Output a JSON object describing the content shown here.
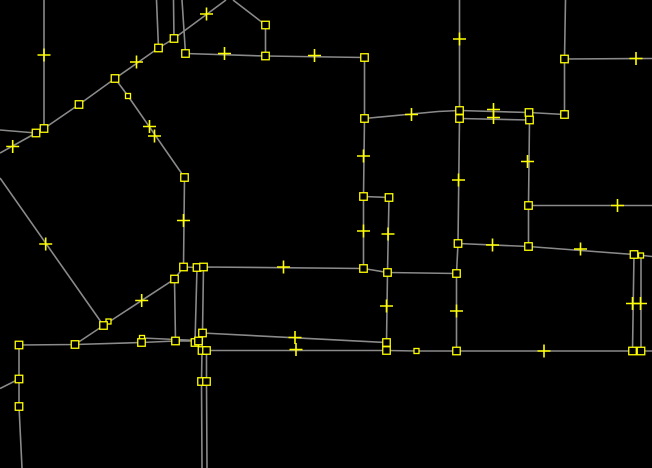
{
  "canvas": {
    "width": 652,
    "height": 468,
    "background_color": "#000000",
    "way_color": "#8a8a8a",
    "way_stroke_width": 1.6,
    "node_color": "#ffff00",
    "node_size": 7.5,
    "small_node_size": 5,
    "node_stroke_width": 1.3,
    "virtual_node_arm": 6.5,
    "virtual_node_stroke_width": 1.6
  },
  "geometry": {
    "ways": [
      {
        "points": [
          [
            0,
            153
          ],
          [
            36,
            133
          ],
          [
            44,
            128.5
          ],
          [
            79,
            104.5
          ],
          [
            115,
            78.5
          ],
          [
            158.5,
            48
          ],
          [
            174,
            38.5
          ],
          [
            226,
            0
          ]
        ]
      },
      {
        "points": [
          [
            115,
            78.5
          ],
          [
            128,
            96
          ],
          [
            184.5,
            177.5
          ],
          [
            183.5,
            267
          ]
        ]
      },
      {
        "points": [
          [
            44,
            0
          ],
          [
            44,
            128.5
          ]
        ]
      },
      {
        "points": [
          [
            0,
            130
          ],
          [
            36,
            133
          ]
        ]
      },
      {
        "points": [
          [
            0,
            178
          ],
          [
            103.5,
            325.5
          ]
        ]
      },
      {
        "points": [
          [
            103.5,
            325.5
          ],
          [
            174.5,
            279
          ],
          [
            183.5,
            267
          ]
        ]
      },
      {
        "points": [
          [
            103.5,
            325.5
          ],
          [
            75,
            344.5
          ],
          [
            19,
            345
          ],
          [
            19,
            379
          ],
          [
            19,
            406.5
          ],
          [
            22,
            468
          ]
        ]
      },
      {
        "points": [
          [
            0,
            388.5
          ],
          [
            19,
            379
          ]
        ]
      },
      {
        "points": [
          [
            75,
            344.5
          ],
          [
            141.5,
            342.5
          ],
          [
            175.5,
            341
          ],
          [
            198.5,
            341
          ]
        ]
      },
      {
        "points": [
          [
            142,
            338
          ],
          [
            198.5,
            340.5
          ]
        ]
      },
      {
        "points": [
          [
            197,
            267.5
          ],
          [
            195,
            342.5
          ]
        ]
      },
      {
        "points": [
          [
            203.5,
            267
          ],
          [
            202.5,
            333
          ],
          [
            202,
            350.5
          ],
          [
            201.5,
            381.5
          ],
          [
            202,
            468
          ]
        ]
      },
      {
        "points": [
          [
            206.5,
            350.5
          ],
          [
            206.5,
            381.5
          ],
          [
            207,
            468
          ]
        ]
      },
      {
        "points": [
          [
            174.5,
            279
          ],
          [
            175.5,
            341
          ]
        ]
      },
      {
        "points": [
          [
            202.5,
            333
          ],
          [
            386.5,
            342.5
          ]
        ]
      },
      {
        "points": [
          [
            202,
            350.5
          ],
          [
            386.5,
            350.5
          ],
          [
            416.5,
            351
          ],
          [
            456.5,
            351
          ],
          [
            632.5,
            351
          ],
          [
            641,
            351
          ],
          [
            652,
            351
          ]
        ]
      },
      {
        "points": [
          [
            183.5,
            267
          ],
          [
            197,
            267.5
          ],
          [
            203.5,
            267
          ],
          [
            363.5,
            268.5
          ],
          [
            387.5,
            272.5
          ],
          [
            456.5,
            273.5
          ]
        ]
      },
      {
        "points": [
          [
            389,
            197.5
          ],
          [
            387.5,
            272.5
          ],
          [
            386.5,
            342.5
          ],
          [
            386.5,
            350.5
          ]
        ]
      },
      {
        "points": [
          [
            182,
            0
          ],
          [
            185.5,
            53.5
          ],
          [
            265.5,
            56
          ],
          [
            364.5,
            57.5
          ]
        ]
      },
      {
        "points": [
          [
            233,
            0
          ],
          [
            265.5,
            25
          ],
          [
            265.5,
            56
          ]
        ]
      },
      {
        "points": [
          [
            156.5,
            0
          ],
          [
            158.5,
            48
          ]
        ]
      },
      {
        "points": [
          [
            173.5,
            0
          ],
          [
            174,
            38.5
          ]
        ]
      },
      {
        "points": [
          [
            364.5,
            57.5
          ],
          [
            364.5,
            118.5
          ],
          [
            363.5,
            196.5
          ],
          [
            363.5,
            268.5
          ]
        ]
      },
      {
        "points": [
          [
            363.5,
            196.5
          ],
          [
            389,
            197.5
          ]
        ]
      },
      {
        "points": [
          [
            364.5,
            118.5
          ],
          [
            438,
            111.5
          ],
          [
            459.5,
            110.5
          ],
          [
            529,
            112.5
          ],
          [
            564.5,
            114.5
          ]
        ]
      },
      {
        "points": [
          [
            459.5,
            118.5
          ],
          [
            529.5,
            120
          ]
        ]
      },
      {
        "points": [
          [
            459.5,
            0
          ],
          [
            459.5,
            110.5
          ],
          [
            459.5,
            118.5
          ],
          [
            458,
            243.5
          ],
          [
            456.5,
            273.5
          ],
          [
            456.5,
            351
          ]
        ]
      },
      {
        "points": [
          [
            565.5,
            0
          ],
          [
            564.5,
            59
          ],
          [
            564.5,
            114.5
          ]
        ]
      },
      {
        "points": [
          [
            564.5,
            59
          ],
          [
            652,
            58.5
          ]
        ]
      },
      {
        "points": [
          [
            529.5,
            120
          ],
          [
            528.5,
            205.5
          ],
          [
            528.5,
            246.5
          ]
        ]
      },
      {
        "points": [
          [
            528.5,
            205.5
          ],
          [
            652,
            205.5
          ]
        ]
      },
      {
        "points": [
          [
            458,
            243.5
          ],
          [
            528.5,
            246.5
          ],
          [
            634,
            254.5
          ],
          [
            652,
            256.5
          ]
        ]
      },
      {
        "points": [
          [
            634,
            254.5
          ],
          [
            632.5,
            351
          ]
        ]
      },
      {
        "points": [
          [
            641,
            255.5
          ],
          [
            641,
            351
          ]
        ]
      }
    ],
    "nodes": [
      [
        36,
        133
      ],
      [
        44,
        128.5
      ],
      [
        79,
        104.5
      ],
      [
        115,
        78.5
      ],
      [
        158.5,
        48
      ],
      [
        174,
        38.5
      ],
      [
        185.5,
        53.5
      ],
      [
        265.5,
        25
      ],
      [
        265.5,
        56
      ],
      [
        364.5,
        57.5
      ],
      [
        184.5,
        177.5
      ],
      [
        183.5,
        267
      ],
      [
        197,
        267.5
      ],
      [
        203.5,
        267
      ],
      [
        174.5,
        279
      ],
      [
        364.5,
        118.5
      ],
      [
        363.5,
        196.5
      ],
      [
        389,
        197.5
      ],
      [
        363.5,
        268.5
      ],
      [
        387.5,
        272.5
      ],
      [
        386.5,
        342.5
      ],
      [
        386.5,
        350.5
      ],
      [
        458,
        243.5
      ],
      [
        456.5,
        273.5
      ],
      [
        456.5,
        351
      ],
      [
        459.5,
        110.5
      ],
      [
        459.5,
        118.5
      ],
      [
        529,
        112.5
      ],
      [
        529.5,
        120
      ],
      [
        564.5,
        59
      ],
      [
        564.5,
        114.5
      ],
      [
        528.5,
        205.5
      ],
      [
        528.5,
        246.5
      ],
      [
        634,
        254.5
      ],
      [
        632.5,
        351
      ],
      [
        641,
        351
      ],
      [
        19,
        345
      ],
      [
        75,
        344.5
      ],
      [
        19,
        379
      ],
      [
        19,
        406.5
      ],
      [
        103.5,
        325.5
      ],
      [
        141.5,
        342.5
      ],
      [
        175.5,
        341
      ],
      [
        195,
        342.5
      ],
      [
        198.5,
        341
      ],
      [
        202.5,
        333
      ],
      [
        202,
        350.5
      ],
      [
        206.5,
        350.5
      ],
      [
        201.5,
        381.5
      ],
      [
        206.5,
        381.5
      ]
    ],
    "small_nodes": [
      [
        128,
        96
      ],
      [
        108.5,
        321.5
      ],
      [
        142,
        338
      ],
      [
        416.5,
        351
      ],
      [
        641,
        255.5
      ]
    ],
    "virtual_nodes": [
      [
        12.7,
        146.5
      ],
      [
        44,
        55
      ],
      [
        136.5,
        62
      ],
      [
        206.5,
        14
      ],
      [
        149.5,
        126.5
      ],
      [
        154.5,
        136
      ],
      [
        45.7,
        244
      ],
      [
        141.7,
        300.5
      ],
      [
        183.5,
        220.5
      ],
      [
        224.5,
        53.5
      ],
      [
        314.5,
        55.5
      ],
      [
        363.5,
        156
      ],
      [
        363.5,
        231
      ],
      [
        283.5,
        267
      ],
      [
        388,
        234
      ],
      [
        386.5,
        306
      ],
      [
        295,
        337.5
      ],
      [
        296,
        349.5
      ],
      [
        456.5,
        311
      ],
      [
        544,
        351
      ],
      [
        459.5,
        39
      ],
      [
        458.5,
        180
      ],
      [
        411.5,
        114.5
      ],
      [
        493.5,
        109.5
      ],
      [
        493.5,
        117.5
      ],
      [
        636,
        58.5
      ],
      [
        527.5,
        161.5
      ],
      [
        617.5,
        205.5
      ],
      [
        492.5,
        245
      ],
      [
        580.5,
        249
      ],
      [
        632.5,
        303.5
      ],
      [
        640.5,
        303.5
      ]
    ]
  }
}
